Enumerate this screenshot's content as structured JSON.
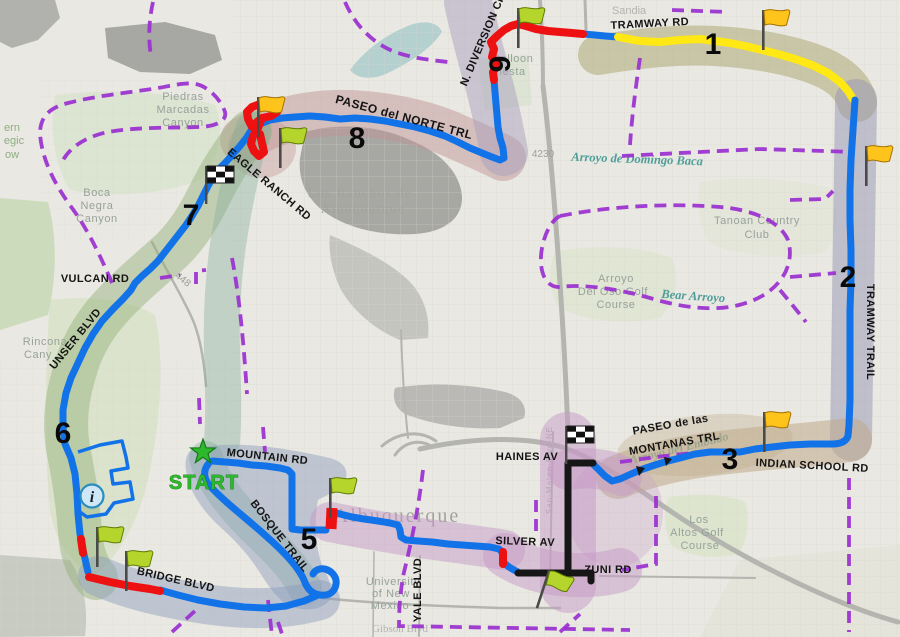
{
  "map": {
    "start": {
      "label": "START"
    },
    "info": {
      "symbol": "i"
    },
    "route_numbers": {
      "n1": "1",
      "n2": "2",
      "n3": "3",
      "n5": "5",
      "n6": "6",
      "n7": "7",
      "n8": "8",
      "n9": "9"
    },
    "route_labels": {
      "tramway_rd": "TRAMWAY RD",
      "n_diversion_ch": "N. DIVERSION CH",
      "paseo_del_norte_trl": "PASEO del NORTE TRL",
      "eagle_ranch_rd": "EAGLE RANCH RD",
      "vulcan_rd": "VULCAN RD",
      "unser_blvd": "UNSER BLVD",
      "bridge_blvd": "BRIDGE BLVD",
      "mountain_rd": "MOUNTAIN RD",
      "bosque_trail": "BOSQUE TRAIL",
      "silver_av": "SILVER AV",
      "yale_blvd": "YALE BLVD",
      "zuni_rd": "ZUNI RD",
      "haines_av": "HAINES AV",
      "paseo_de_las": "PASEO de las",
      "montanas_trl": "MONTANAS TRL",
      "indian_school_rd": "INDIAN SCHOOL RD",
      "tramway_trail": "TRAMWAY TRAIL"
    },
    "area_labels": {
      "sandia": "Sandia",
      "piedras": [
        "Piedras",
        "Marcadas",
        "Canyon"
      ],
      "boca": [
        "Boca",
        "Negra",
        "Canyon"
      ],
      "rinconada": [
        "Rincona",
        "Cany"
      ],
      "left_edge": [
        "ern",
        "egic",
        "ow"
      ],
      "los_ranchos": [
        "Los Ranchos de",
        "Albuquerque"
      ],
      "balloon": [
        "Balloon",
        "Fiesta"
      ],
      "albuquerque": "Albuquerque",
      "tanoan": [
        "Tanoan Country",
        "Club"
      ],
      "arroyo_oso": [
        "Arroyo",
        "Del Oso Golf",
        "Course"
      ],
      "bear": "Bear Arroyo",
      "domingo": "Arroyo de Domingo Baca",
      "embudo": "Arroyo del Embudo",
      "unm": [
        "University",
        "of New",
        "Mexico"
      ],
      "gibson": "Gibson Blvd",
      "los_altos": [
        "Los",
        "Altos Golf",
        "Course"
      ],
      "san_mateo": "San-Mateo-Blvd-NE",
      "road_448": "448",
      "road_4230": "4230"
    },
    "colors": {
      "route_blue": "#1273e8",
      "route_red": "#ee1111",
      "route_yellow": "#ffe813",
      "route_black": "#161616",
      "boundary_purple": "#9a2fd0",
      "start_green": "#2eb82e",
      "band_olive": "#a8a469",
      "band_lavender": "#9594b3",
      "band_tan": "#bfa98a",
      "band_rose": "#c29597",
      "band_mauve": "#aaa0bd",
      "band_green": "#93b077",
      "band_teal": "#84af9b",
      "band_slate": "#8a9cbd",
      "band_plum": "#c69ac6"
    }
  }
}
